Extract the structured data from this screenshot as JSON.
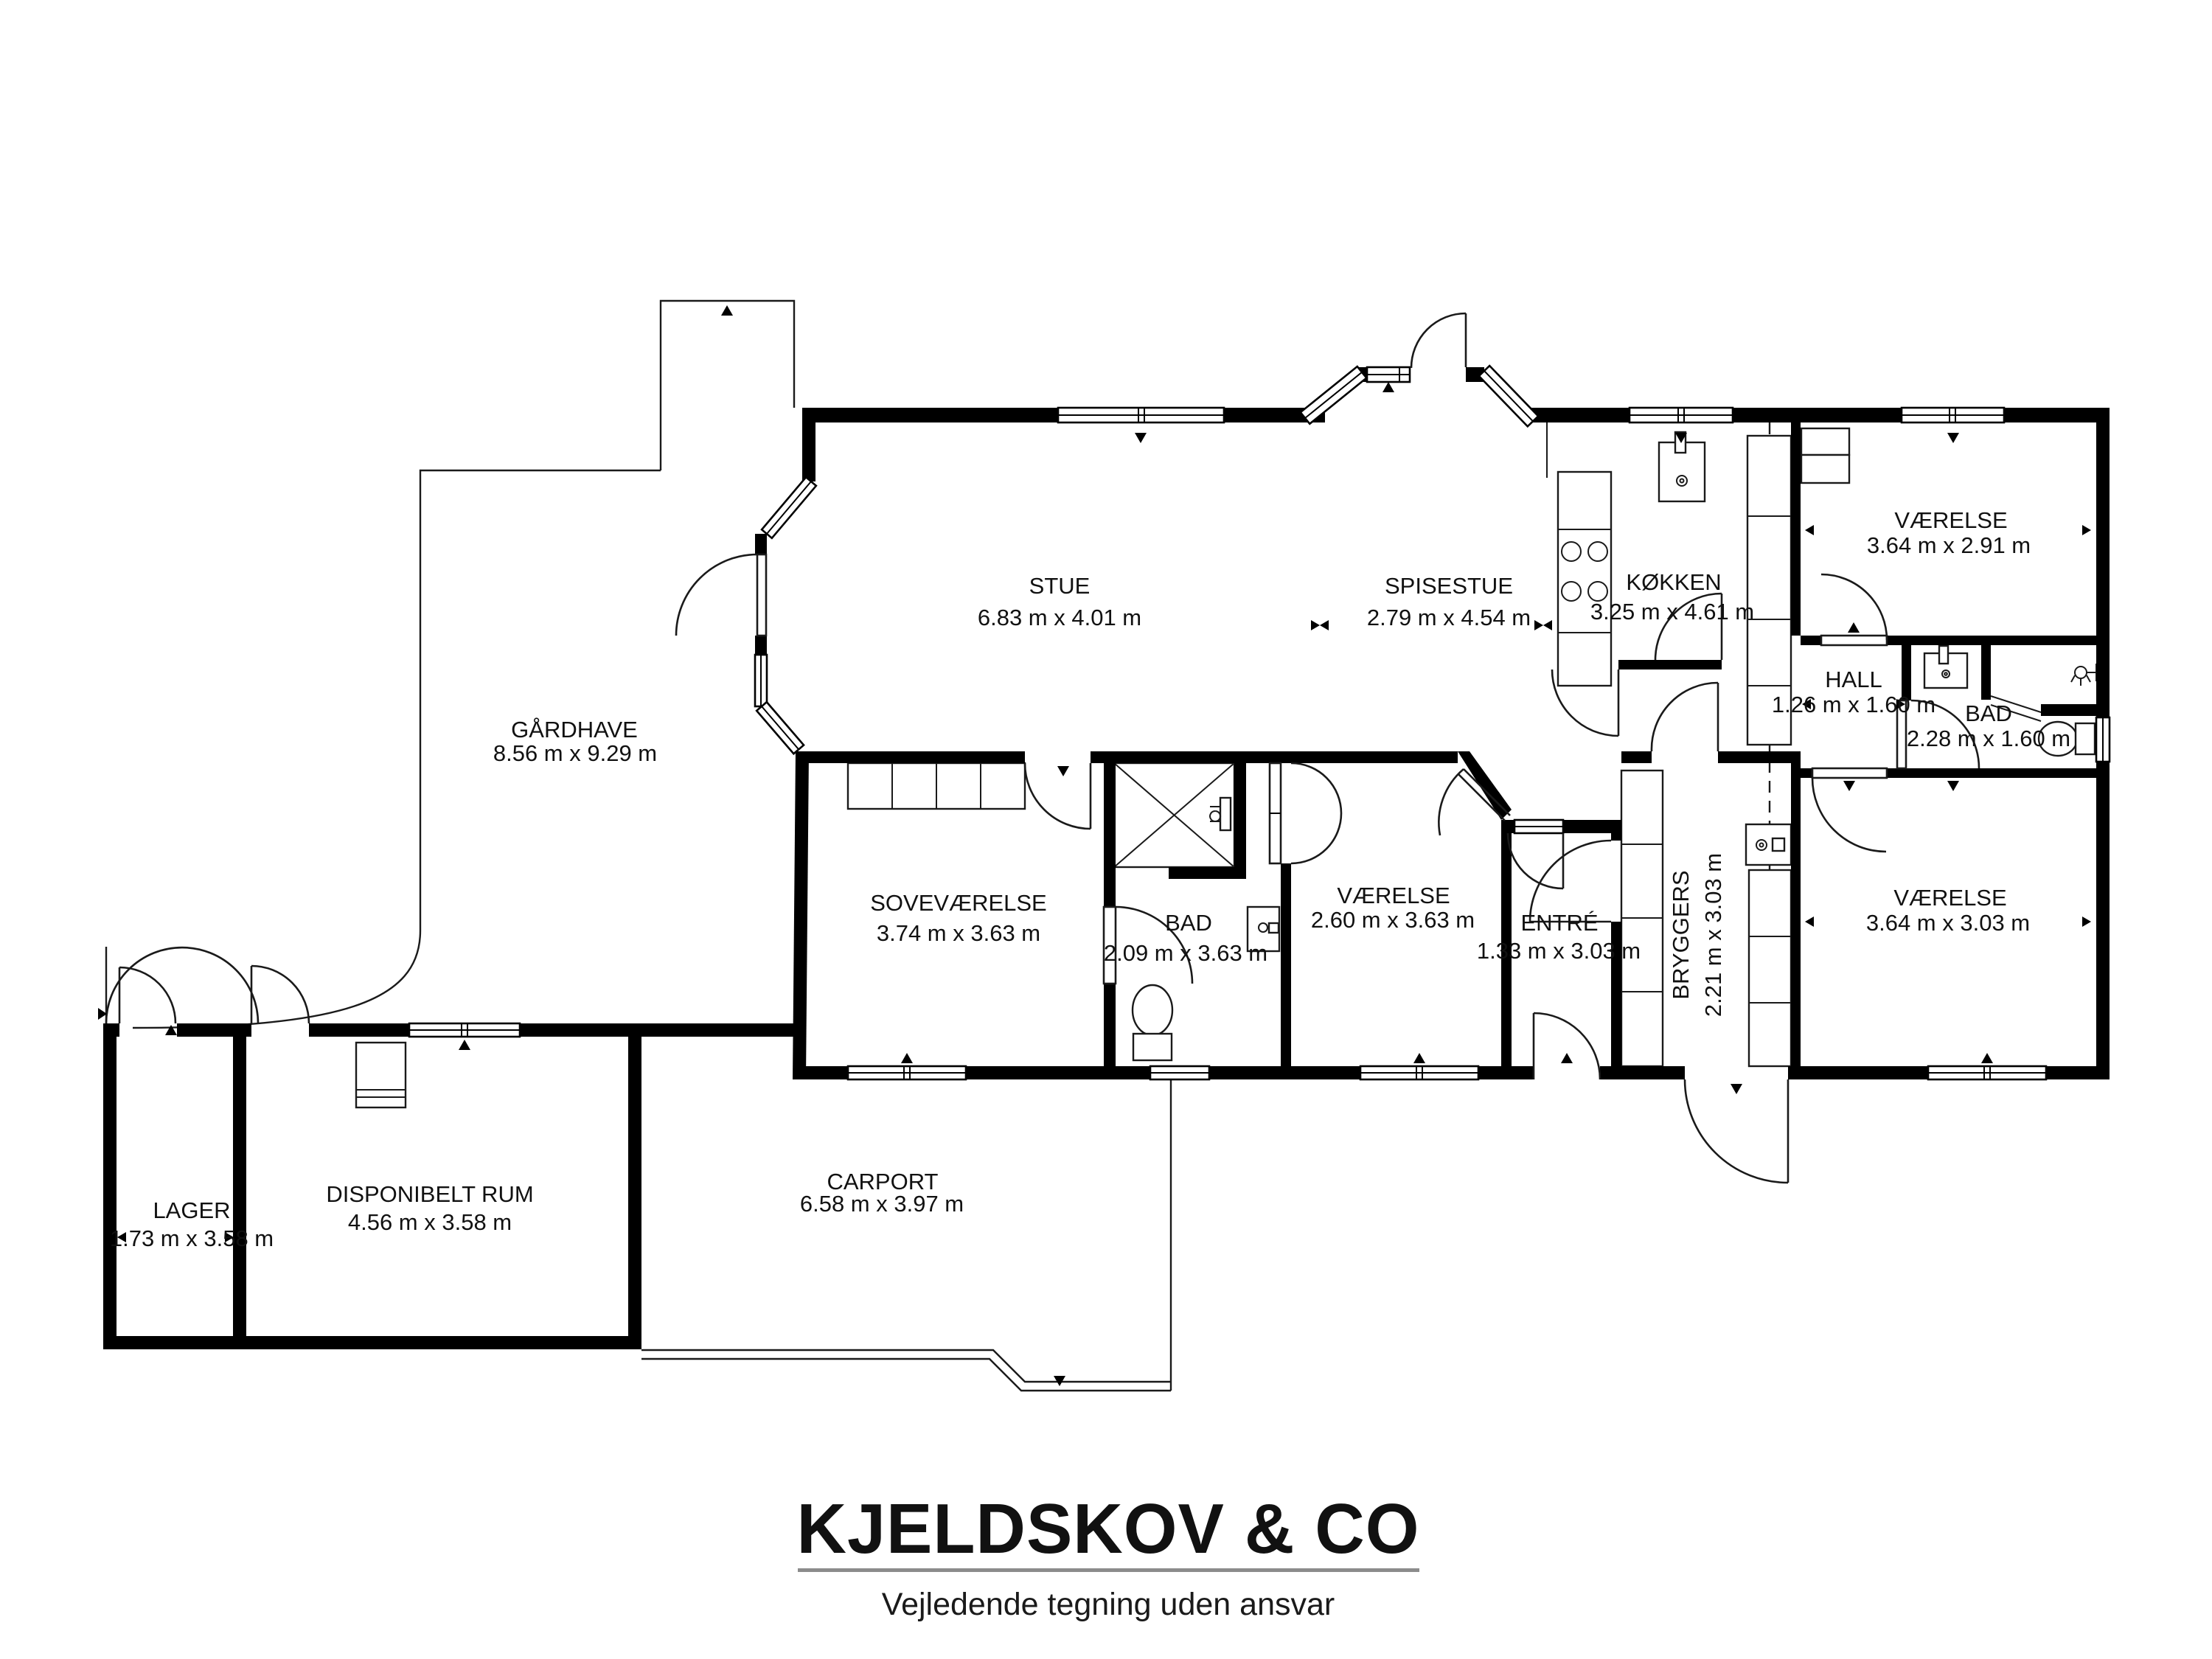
{
  "meta": {
    "document_type": "floor-plan",
    "colors": {
      "wall": "#000000",
      "footer_rule": "#8c8c8c",
      "background": "#ffffff"
    }
  },
  "rooms": {
    "stue": {
      "name": "STUE",
      "dims": "6.83 m x 4.01 m"
    },
    "spisestue": {
      "name": "SPISESTUE",
      "dims": "2.79 m x 4.54 m"
    },
    "kokken": {
      "name": "KØKKEN",
      "dims": "3.25 m x 4.61 m"
    },
    "vaerelse_ne": {
      "name": "VÆRELSE",
      "dims": "3.64 m x 2.91 m"
    },
    "gaardhave": {
      "name": "GÅRDHAVE",
      "dims": "8.56 m x 9.29 m"
    },
    "hall": {
      "name": "HALL",
      "dims": "1.26 m x 1.60 m"
    },
    "bad_east": {
      "name": "BAD",
      "dims": "2.28 m x 1.60 m"
    },
    "sovevaerelse": {
      "name": "SOVEVÆRELSE",
      "dims": "3.74 m x 3.63 m"
    },
    "bad_mid": {
      "name": "BAD",
      "dims": "2.09 m x 3.63 m"
    },
    "vaerelse_mid": {
      "name": "VÆRELSE",
      "dims": "2.60 m x 3.63 m"
    },
    "entre": {
      "name": "ENTRÉ",
      "dims": "1.33 m x 3.03 m"
    },
    "bryggers": {
      "name": "BRYGGERS",
      "dims": "2.21 m x 3.03 m"
    },
    "vaerelse_se": {
      "name": "VÆRELSE",
      "dims": "3.64 m x 3.03 m"
    },
    "lager": {
      "name": "LAGER",
      "dims": "1.73 m x 3.58 m"
    },
    "disponibelt": {
      "name": "DISPONIBELT RUM",
      "dims": "4.56 m x 3.58 m"
    },
    "carport": {
      "name": "CARPORT",
      "dims": "6.58 m x 3.97 m"
    }
  },
  "footer": {
    "brand": "KJELDSKOV & CO",
    "disclaimer": "Vejledende tegning uden ansvar"
  }
}
